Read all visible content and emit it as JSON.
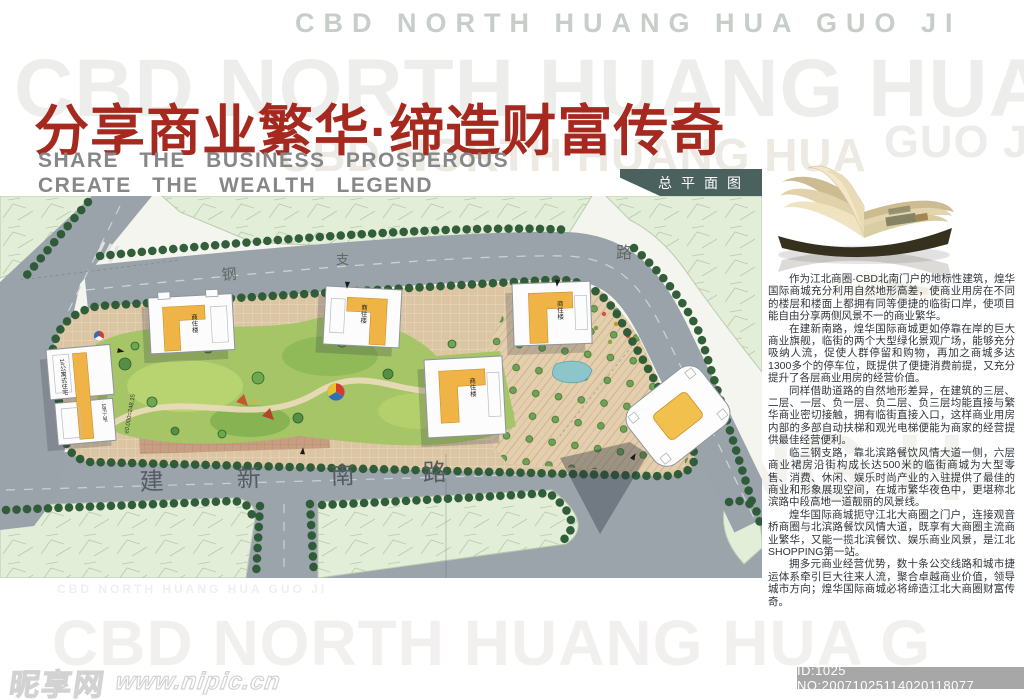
{
  "header": {
    "watermark_small_top": "CBD NORTH HUANG HUA GUO JI",
    "watermark_huge": "CBD NORTH HUANG HUA GUO",
    "watermark_mid": "CBD NORTH HUANG HUA",
    "watermark_guoji": "GUO JI",
    "headline": "分享商业繁华·缔造财富传奇",
    "headline_color": "#a6291f",
    "subtitle_line1": "SHARE THE BUSINESS PROSPEROUS",
    "subtitle_line2": "CREATE THE WEALTH LEGEND"
  },
  "plan": {
    "badge_label": "总平面图",
    "badge_bg": "#4a615e",
    "bottom_road_chars": [
      "建",
      "新",
      "南",
      "路"
    ],
    "top_road_chars": [
      "钢",
      "支",
      "路"
    ],
    "building1_label": "1#公寓式住宅",
    "building1_floors": "18F/-3F",
    "building_label": "商住楼",
    "elevation_note": "±0.000=248.15"
  },
  "article": {
    "paragraphs": [
      "作为江北商圈·CBD北南门户的地标性建筑，煌华国际商城充分利用自然地形高差，使商业用房在不同的楼层和楼面上都拥有同等便捷的临街口岸，使项目能自由分享两侧风景不一的商业繁华。",
      "在建新南路，煌华国际商城更如停靠在岸的巨大商业旗舰，临街的两个大型绿化景观广场，能够充分吸纳人流，促使人群停留和购物，再加之商城多达1300多个的停车位，既提供了便捷消费前提，又充分提升了各层商业用房的经营价值。",
      "同样借助道路的自然地形差异，在建筑的三层、二层、一层、负一层、负二层、负三层均能直接与繁华商业密切接触，拥有临街直接入口，这样商业用房内部的多部自动扶梯和观光电梯便能为商家的经营提供最佳经营便利。",
      "临三钢支路，靠北滨路餐饮风情大道一侧，六层商业裙房沿街构成长达500米的临街商城为大型零售、消费、休闲、娱乐时尚产业的入驻提供了最佳的商业和形象展现空间，在城市繁华夜色中，更堪称北滨路中段高地一道靓丽的风景线。",
      "煌华国际商城扼守江北大商圈之门户，连接观音桥商圈与北滨路餐饮风情大道，既享有大商圈主流商业繁华，又能一揽北滨餐饮、娱乐商业风景，是江北SHOPPING第一站。",
      "拥多元商业经营优势，数十条公交线路和城市捷运体系牵引巨大往来人流，聚合卓越商业价值，领导城市方向；煌华国际商城必将缔造江北大商圈财富传奇。"
    ]
  },
  "footer": {
    "watermark_small": "CBD NORTH HUANG HUA GUO JI",
    "watermark_huge": "CBD NORTH HUANG HUA G",
    "watermark_right": "ANG H",
    "site_name": "昵享网",
    "site_url": "www.nipic.cn",
    "id_label": "ID:1025 NO:20071025114020118077"
  }
}
